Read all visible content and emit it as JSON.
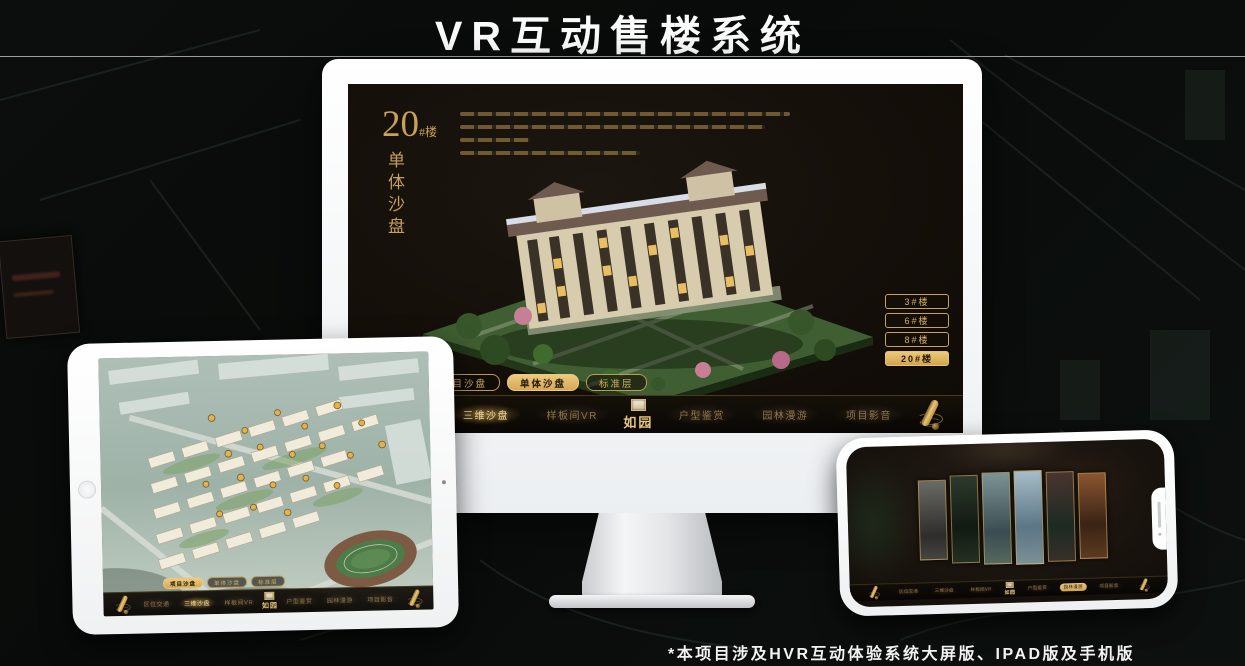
{
  "header": {
    "title": "VR互动售楼系统"
  },
  "footer": {
    "note": "*本项目涉及HVR互动体验系统大屏版、IPAD版及手机版"
  },
  "screen": {
    "building_no": "20",
    "building_suffix": "#楼",
    "view_title": "单体沙盘",
    "building_buttons": [
      "3#楼",
      "6#楼",
      "8#楼",
      "20#楼"
    ],
    "selected_building": "20#楼"
  },
  "tabs": {
    "items": [
      "项目沙盘",
      "单体沙盘",
      "标准层"
    ]
  },
  "nav": {
    "items": [
      "区位交通",
      "三维沙盘",
      "样板间VR",
      "户型鉴赏",
      "园林漫游",
      "项目影音"
    ],
    "logo": "如园"
  },
  "colors": {
    "accent_gold": "#d2a85e",
    "accent_gold_bright": "#ecc878",
    "screen_background": "#140f08",
    "title_text": "#fbfbfb"
  }
}
